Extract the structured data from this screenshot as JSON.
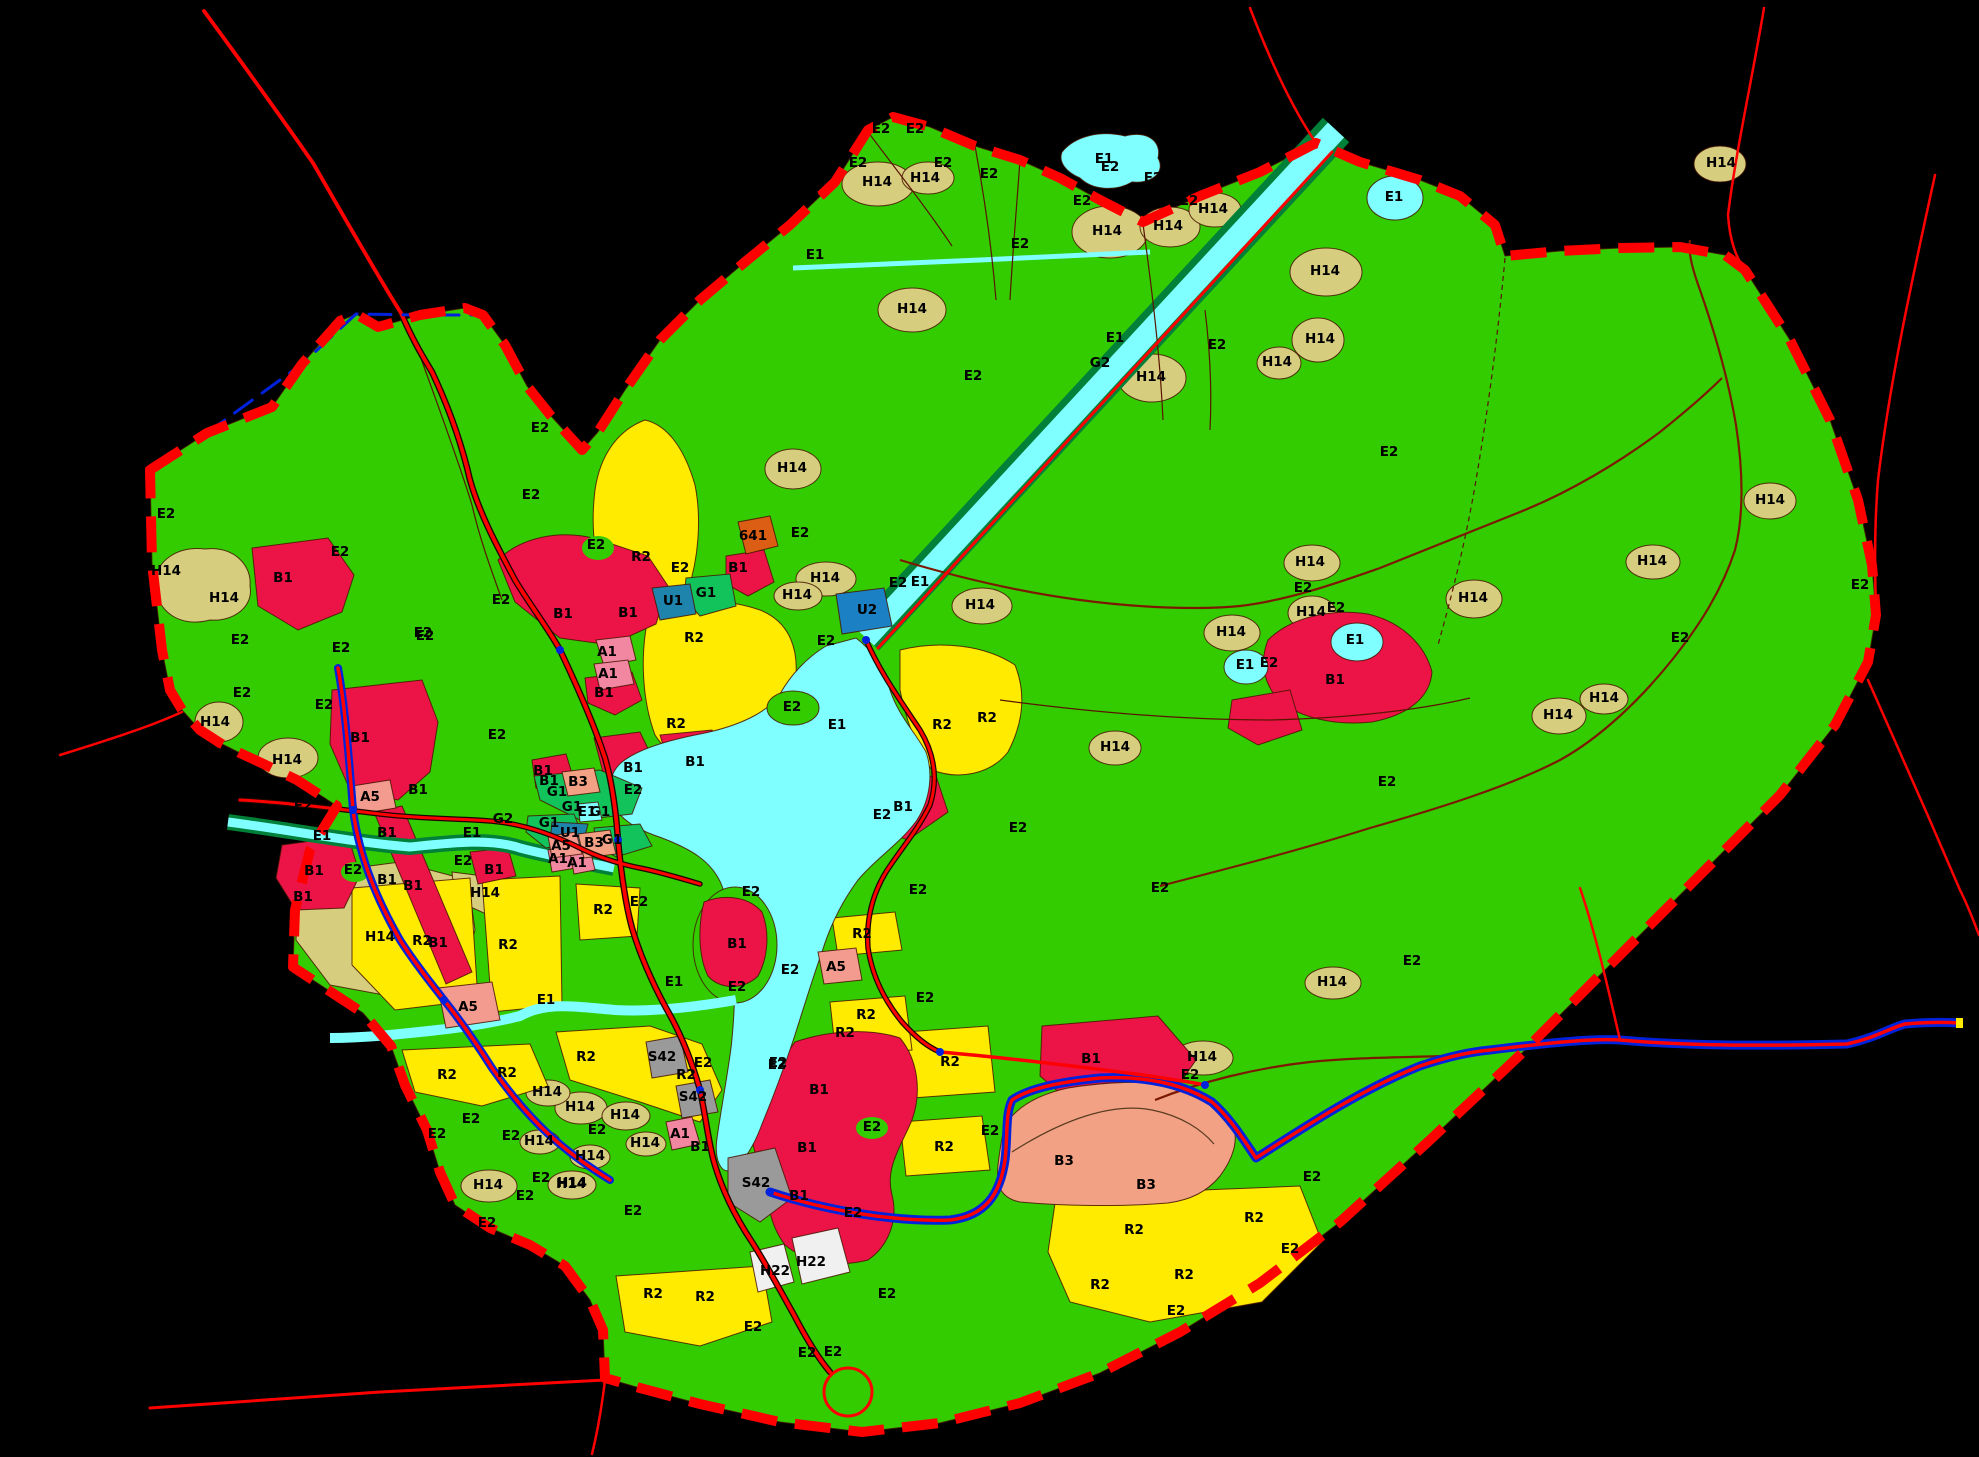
{
  "map": {
    "type": "zoning-map",
    "background": "#000000",
    "legend_colors": {
      "E2": "#33CC00",
      "H14": "#D6CE7E",
      "E1": "#7FFFFF",
      "B1": "#EC1446",
      "R2": "#FFEB00",
      "B3": "#F2A184",
      "A1": "#F287A2",
      "A5": "#F29B8E",
      "G1": "#12C35C",
      "G2": "#008038",
      "U1": "#1E84AC",
      "U2": "#1B80C4",
      "S42": "#9A9A9A",
      "H22": "#F0F0F0",
      "641": "#DC5E14",
      "boundary": "#FF0000",
      "road": "#FF0000",
      "creek": "#7B1A00",
      "water_line": "#0022DD"
    },
    "labels": [
      {
        "t": "E2",
        "x": 881,
        "y": 129
      },
      {
        "t": "E2",
        "x": 915,
        "y": 129
      },
      {
        "t": "E2",
        "x": 858,
        "y": 163
      },
      {
        "t": "E2",
        "x": 943,
        "y": 163
      },
      {
        "t": "E2",
        "x": 810,
        "y": 190
      },
      {
        "t": "E2",
        "x": 989,
        "y": 174
      },
      {
        "t": "E2",
        "x": 1110,
        "y": 167
      },
      {
        "t": "E2",
        "x": 1153,
        "y": 178
      },
      {
        "t": "E2",
        "x": 1082,
        "y": 201
      },
      {
        "t": "E2",
        "x": 1189,
        "y": 201
      },
      {
        "t": "E2",
        "x": 1020,
        "y": 244
      },
      {
        "t": "E2",
        "x": 973,
        "y": 376
      },
      {
        "t": "E2",
        "x": 1217,
        "y": 345
      },
      {
        "t": "E2",
        "x": 1389,
        "y": 452
      },
      {
        "t": "E2",
        "x": 166,
        "y": 514
      },
      {
        "t": "E2",
        "x": 240,
        "y": 640
      },
      {
        "t": "E2",
        "x": 242,
        "y": 693
      },
      {
        "t": "E2",
        "x": 341,
        "y": 648
      },
      {
        "t": "E2",
        "x": 425,
        "y": 636
      },
      {
        "t": "E2",
        "x": 324,
        "y": 705
      },
      {
        "t": "E2",
        "x": 303,
        "y": 806
      },
      {
        "t": "E2",
        "x": 497,
        "y": 735
      },
      {
        "t": "E2",
        "x": 540,
        "y": 428
      },
      {
        "t": "E2",
        "x": 531,
        "y": 495
      },
      {
        "t": "E2",
        "x": 340,
        "y": 552
      },
      {
        "t": "E2",
        "x": 596,
        "y": 545
      },
      {
        "t": "E2",
        "x": 680,
        "y": 568
      },
      {
        "t": "E2",
        "x": 800,
        "y": 533
      },
      {
        "t": "E2",
        "x": 826,
        "y": 641
      },
      {
        "t": "E2",
        "x": 898,
        "y": 583
      },
      {
        "t": "E2",
        "x": 792,
        "y": 707
      },
      {
        "t": "E2",
        "x": 882,
        "y": 815
      },
      {
        "t": "E2",
        "x": 1018,
        "y": 828
      },
      {
        "t": "E2",
        "x": 633,
        "y": 790
      },
      {
        "t": "E2",
        "x": 463,
        "y": 861
      },
      {
        "t": "E2",
        "x": 353,
        "y": 870
      },
      {
        "t": "E2",
        "x": 501,
        "y": 600
      },
      {
        "t": "E2",
        "x": 423,
        "y": 633
      },
      {
        "t": "E2",
        "x": 1303,
        "y": 588
      },
      {
        "t": "E2",
        "x": 1336,
        "y": 608
      },
      {
        "t": "E2",
        "x": 1269,
        "y": 663
      },
      {
        "t": "E2",
        "x": 1387,
        "y": 782
      },
      {
        "t": "E2",
        "x": 1680,
        "y": 638
      },
      {
        "t": "E2",
        "x": 1860,
        "y": 585
      },
      {
        "t": "E2",
        "x": 1160,
        "y": 888
      },
      {
        "t": "E2",
        "x": 1412,
        "y": 961
      },
      {
        "t": "E2",
        "x": 1190,
        "y": 1075
      },
      {
        "t": "E2",
        "x": 990,
        "y": 1131
      },
      {
        "t": "E2",
        "x": 1312,
        "y": 1177
      },
      {
        "t": "E2",
        "x": 1290,
        "y": 1249
      },
      {
        "t": "E2",
        "x": 1176,
        "y": 1311
      },
      {
        "t": "E2",
        "x": 918,
        "y": 890
      },
      {
        "t": "E2",
        "x": 925,
        "y": 998
      },
      {
        "t": "E2",
        "x": 790,
        "y": 970
      },
      {
        "t": "E2",
        "x": 737,
        "y": 987
      },
      {
        "t": "E2",
        "x": 778,
        "y": 1063
      },
      {
        "t": "E2",
        "x": 872,
        "y": 1127
      },
      {
        "t": "E2",
        "x": 751,
        "y": 892
      },
      {
        "t": "E2",
        "x": 639,
        "y": 902
      },
      {
        "t": "E2",
        "x": 703,
        "y": 1063
      },
      {
        "t": "E2",
        "x": 777,
        "y": 1065
      },
      {
        "t": "E2",
        "x": 471,
        "y": 1119
      },
      {
        "t": "E2",
        "x": 437,
        "y": 1134
      },
      {
        "t": "E2",
        "x": 511,
        "y": 1136
      },
      {
        "t": "E2",
        "x": 525,
        "y": 1196
      },
      {
        "t": "E2",
        "x": 541,
        "y": 1178
      },
      {
        "t": "E2",
        "x": 487,
        "y": 1223
      },
      {
        "t": "E2",
        "x": 633,
        "y": 1211
      },
      {
        "t": "E2",
        "x": 753,
        "y": 1327
      },
      {
        "t": "E2",
        "x": 853,
        "y": 1213
      },
      {
        "t": "E2",
        "x": 887,
        "y": 1294
      },
      {
        "t": "E2",
        "x": 807,
        "y": 1353
      },
      {
        "t": "E2",
        "x": 833,
        "y": 1352
      },
      {
        "t": "E2",
        "x": 597,
        "y": 1130
      },
      {
        "t": "H14",
        "x": 166,
        "y": 571
      },
      {
        "t": "H14",
        "x": 224,
        "y": 598
      },
      {
        "t": "H14",
        "x": 215,
        "y": 722
      },
      {
        "t": "H14",
        "x": 287,
        "y": 760
      },
      {
        "t": "H14",
        "x": 380,
        "y": 937
      },
      {
        "t": "H14",
        "x": 485,
        "y": 893
      },
      {
        "t": "H14",
        "x": 877,
        "y": 182
      },
      {
        "t": "H14",
        "x": 925,
        "y": 178
      },
      {
        "t": "H14",
        "x": 912,
        "y": 309
      },
      {
        "t": "H14",
        "x": 1107,
        "y": 231
      },
      {
        "t": "H14",
        "x": 1168,
        "y": 226
      },
      {
        "t": "H14",
        "x": 1213,
        "y": 209
      },
      {
        "t": "H14",
        "x": 1151,
        "y": 377
      },
      {
        "t": "H14",
        "x": 1325,
        "y": 271
      },
      {
        "t": "H14",
        "x": 1320,
        "y": 339
      },
      {
        "t": "H14",
        "x": 1277,
        "y": 362
      },
      {
        "t": "H14",
        "x": 1721,
        "y": 163
      },
      {
        "t": "H14",
        "x": 1310,
        "y": 562
      },
      {
        "t": "H14",
        "x": 1311,
        "y": 612
      },
      {
        "t": "H14",
        "x": 1231,
        "y": 632
      },
      {
        "t": "H14",
        "x": 1473,
        "y": 598
      },
      {
        "t": "H14",
        "x": 1652,
        "y": 561
      },
      {
        "t": "H14",
        "x": 1558,
        "y": 715
      },
      {
        "t": "H14",
        "x": 1604,
        "y": 698
      },
      {
        "t": "H14",
        "x": 1770,
        "y": 500
      },
      {
        "t": "H14",
        "x": 825,
        "y": 578
      },
      {
        "t": "H14",
        "x": 797,
        "y": 595
      },
      {
        "t": "H14",
        "x": 980,
        "y": 605
      },
      {
        "t": "H14",
        "x": 792,
        "y": 468
      },
      {
        "t": "H14",
        "x": 1115,
        "y": 747
      },
      {
        "t": "H14",
        "x": 580,
        "y": 1107
      },
      {
        "t": "H14",
        "x": 625,
        "y": 1115
      },
      {
        "t": "H14",
        "x": 547,
        "y": 1092
      },
      {
        "t": "H14",
        "x": 488,
        "y": 1185
      },
      {
        "t": "H14",
        "x": 571,
        "y": 1184
      },
      {
        "t": "H14",
        "x": 539,
        "y": 1141
      },
      {
        "t": "H14",
        "x": 590,
        "y": 1156
      },
      {
        "t": "H14",
        "x": 1202,
        "y": 1057
      },
      {
        "t": "H14",
        "x": 1332,
        "y": 982
      },
      {
        "t": "H14",
        "x": 572,
        "y": 1183
      },
      {
        "t": "H14",
        "x": 645,
        "y": 1143
      },
      {
        "t": "B1",
        "x": 283,
        "y": 578
      },
      {
        "t": "B1",
        "x": 563,
        "y": 614
      },
      {
        "t": "B1",
        "x": 628,
        "y": 613
      },
      {
        "t": "B1",
        "x": 604,
        "y": 693
      },
      {
        "t": "B1",
        "x": 360,
        "y": 738
      },
      {
        "t": "B1",
        "x": 418,
        "y": 790
      },
      {
        "t": "B1",
        "x": 387,
        "y": 833
      },
      {
        "t": "B1",
        "x": 387,
        "y": 880
      },
      {
        "t": "B1",
        "x": 413,
        "y": 886
      },
      {
        "t": "B1",
        "x": 438,
        "y": 943
      },
      {
        "t": "B1",
        "x": 314,
        "y": 871
      },
      {
        "t": "B1",
        "x": 303,
        "y": 897
      },
      {
        "t": "B1",
        "x": 494,
        "y": 870
      },
      {
        "t": "B1",
        "x": 543,
        "y": 771
      },
      {
        "t": "B1",
        "x": 549,
        "y": 781
      },
      {
        "t": "B1",
        "x": 633,
        "y": 768
      },
      {
        "t": "B1",
        "x": 695,
        "y": 762
      },
      {
        "t": "B1",
        "x": 737,
        "y": 944
      },
      {
        "t": "B1",
        "x": 738,
        "y": 568
      },
      {
        "t": "B1",
        "x": 903,
        "y": 807
      },
      {
        "t": "B1",
        "x": 819,
        "y": 1090
      },
      {
        "t": "B1",
        "x": 807,
        "y": 1148
      },
      {
        "t": "B1",
        "x": 799,
        "y": 1196
      },
      {
        "t": "B1",
        "x": 1091,
        "y": 1059
      },
      {
        "t": "B1",
        "x": 1335,
        "y": 680
      },
      {
        "t": "B1",
        "x": 700,
        "y": 1147
      },
      {
        "t": "R2",
        "x": 641,
        "y": 557
      },
      {
        "t": "R2",
        "x": 694,
        "y": 638
      },
      {
        "t": "R2",
        "x": 676,
        "y": 724
      },
      {
        "t": "R2",
        "x": 942,
        "y": 725
      },
      {
        "t": "R2",
        "x": 987,
        "y": 718
      },
      {
        "t": "R2",
        "x": 422,
        "y": 941
      },
      {
        "t": "R2",
        "x": 508,
        "y": 945
      },
      {
        "t": "R2",
        "x": 603,
        "y": 910
      },
      {
        "t": "R2",
        "x": 586,
        "y": 1057
      },
      {
        "t": "R2",
        "x": 686,
        "y": 1075
      },
      {
        "t": "R2",
        "x": 447,
        "y": 1075
      },
      {
        "t": "R2",
        "x": 507,
        "y": 1073
      },
      {
        "t": "R2",
        "x": 653,
        "y": 1294
      },
      {
        "t": "R2",
        "x": 705,
        "y": 1297
      },
      {
        "t": "R2",
        "x": 1134,
        "y": 1230
      },
      {
        "t": "R2",
        "x": 1184,
        "y": 1275
      },
      {
        "t": "R2",
        "x": 1100,
        "y": 1285
      },
      {
        "t": "R2",
        "x": 1254,
        "y": 1218
      },
      {
        "t": "R2",
        "x": 950,
        "y": 1062
      },
      {
        "t": "R2",
        "x": 944,
        "y": 1147
      },
      {
        "t": "R2",
        "x": 866,
        "y": 1015
      },
      {
        "t": "R2",
        "x": 845,
        "y": 1033
      },
      {
        "t": "R2",
        "x": 862,
        "y": 934
      },
      {
        "t": "E1",
        "x": 1104,
        "y": 159
      },
      {
        "t": "E1",
        "x": 1394,
        "y": 197
      },
      {
        "t": "E1",
        "x": 815,
        "y": 255
      },
      {
        "t": "E1",
        "x": 1115,
        "y": 338
      },
      {
        "t": "E1",
        "x": 920,
        "y": 582
      },
      {
        "t": "E1",
        "x": 837,
        "y": 725
      },
      {
        "t": "E1",
        "x": 674,
        "y": 982
      },
      {
        "t": "E1",
        "x": 546,
        "y": 1000
      },
      {
        "t": "E1",
        "x": 322,
        "y": 836
      },
      {
        "t": "E1",
        "x": 472,
        "y": 833
      },
      {
        "t": "E1",
        "x": 587,
        "y": 812
      },
      {
        "t": "E1",
        "x": 1355,
        "y": 640
      },
      {
        "t": "E1",
        "x": 1245,
        "y": 665
      },
      {
        "t": "G1",
        "x": 557,
        "y": 792
      },
      {
        "t": "G1",
        "x": 572,
        "y": 807
      },
      {
        "t": "G1",
        "x": 600,
        "y": 812
      },
      {
        "t": "G1",
        "x": 549,
        "y": 823
      },
      {
        "t": "G1",
        "x": 612,
        "y": 840
      },
      {
        "t": "G1",
        "x": 706,
        "y": 593
      },
      {
        "t": "G2",
        "x": 1100,
        "y": 363
      },
      {
        "t": "G2",
        "x": 503,
        "y": 819
      },
      {
        "t": "U1",
        "x": 673,
        "y": 601
      },
      {
        "t": "U1",
        "x": 570,
        "y": 833
      },
      {
        "t": "U2",
        "x": 867,
        "y": 610
      },
      {
        "t": "A1",
        "x": 607,
        "y": 652
      },
      {
        "t": "A1",
        "x": 608,
        "y": 674
      },
      {
        "t": "A1",
        "x": 558,
        "y": 859
      },
      {
        "t": "A1",
        "x": 577,
        "y": 863
      },
      {
        "t": "A1",
        "x": 680,
        "y": 1134
      },
      {
        "t": "A5",
        "x": 561,
        "y": 846
      },
      {
        "t": "A5",
        "x": 468,
        "y": 1007
      },
      {
        "t": "A5",
        "x": 370,
        "y": 797
      },
      {
        "t": "A5",
        "x": 836,
        "y": 967
      },
      {
        "t": "B3",
        "x": 578,
        "y": 782
      },
      {
        "t": "B3",
        "x": 594,
        "y": 843
      },
      {
        "t": "B3",
        "x": 1064,
        "y": 1161
      },
      {
        "t": "B3",
        "x": 1146,
        "y": 1185
      },
      {
        "t": "S42",
        "x": 662,
        "y": 1057
      },
      {
        "t": "S42",
        "x": 693,
        "y": 1097
      },
      {
        "t": "S42",
        "x": 756,
        "y": 1183
      },
      {
        "t": "H22",
        "x": 775,
        "y": 1271
      },
      {
        "t": "H22",
        "x": 811,
        "y": 1262
      },
      {
        "t": "641",
        "x": 753,
        "y": 536
      }
    ]
  }
}
